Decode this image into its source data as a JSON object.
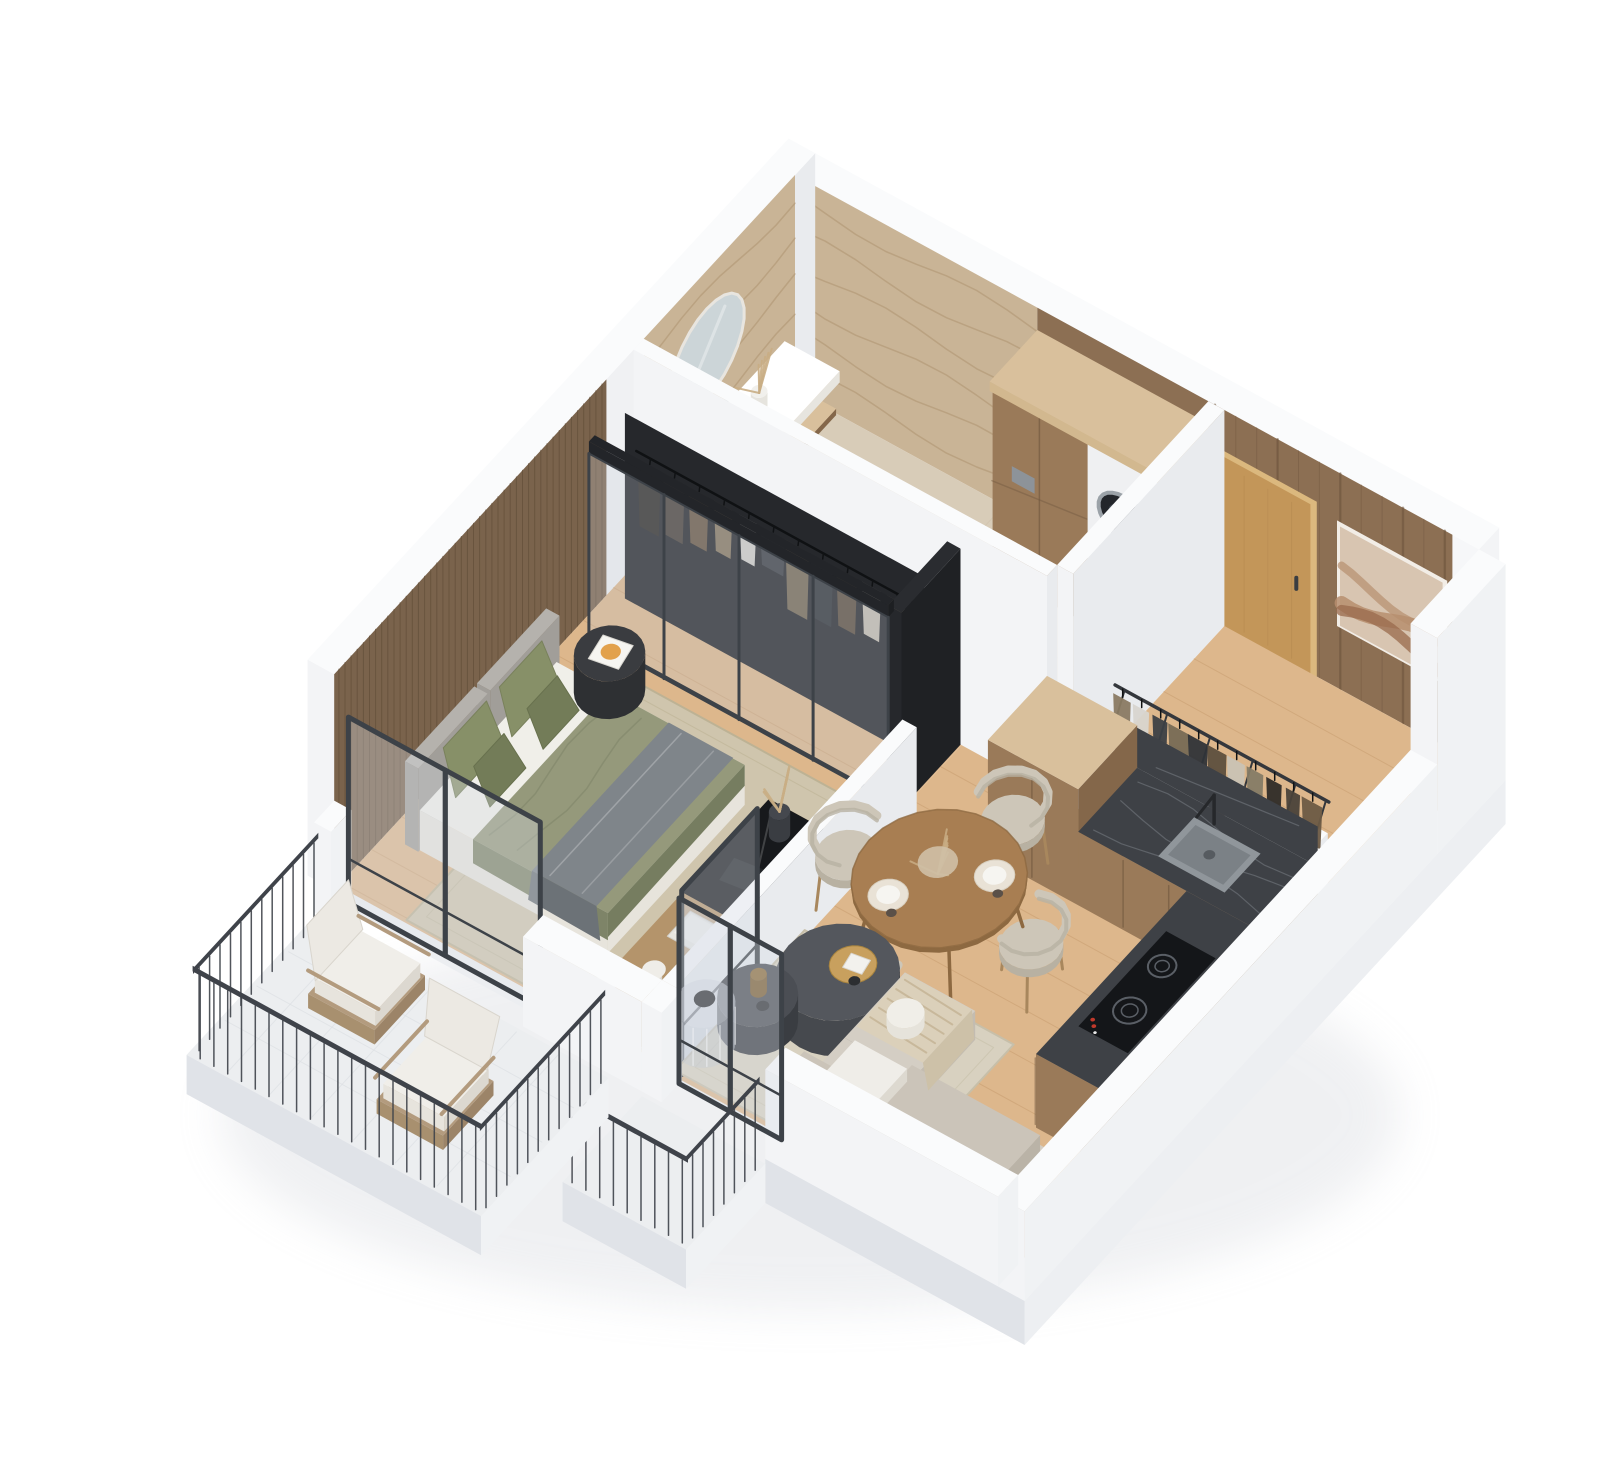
{
  "scene": {
    "title": "3D isometric floor plan render of a one-bedroom apartment with balcony",
    "type": "architectural-isometric-render",
    "rooms": [
      {
        "name": "bathroom",
        "items": [
          "travertine-walls",
          "oval-mirror",
          "vanity-counter",
          "integrated-sink",
          "chrome-faucet",
          "dried-plant",
          "wall-hung-toilet",
          "flush-plate"
        ]
      },
      {
        "name": "utility-column",
        "items": [
          "tall-wood-cabinet",
          "washing-machine-column"
        ]
      },
      {
        "name": "entry-hall",
        "items": [
          "oak-entry-door",
          "wood-panel-wall",
          "abstract-wall-art",
          "open-coat-rack",
          "hanging-clothes"
        ]
      },
      {
        "name": "kitchen",
        "items": [
          "wood-cabinets",
          "dark-marble-counter",
          "dark-marble-backsplash",
          "undermount-sink",
          "black-faucet",
          "induction-cooktop"
        ]
      },
      {
        "name": "dining-area",
        "items": [
          "round-wood-table",
          "curved-dining-chair",
          "curved-dining-chair",
          "curved-dining-chair",
          "curved-dining-chair",
          "dried-flower-centerpiece",
          "place-settings"
        ]
      },
      {
        "name": "living-room",
        "items": [
          "corner-sofa",
          "striped-throw-blanket",
          "ball-pillow",
          "dark-round-coffee-table",
          "small-round-coffee-table",
          "gold-tray",
          "ribbed-glass-side-table",
          "woven-area-rug",
          "glass-partition-panel"
        ]
      },
      {
        "name": "bedroom",
        "items": [
          "wood-slat-wall",
          "double-bed",
          "green-bedding",
          "green-pillows",
          "grey-throw",
          "upholstered-headboard",
          "black-round-side-table",
          "book-with-sun-cover",
          "glass-front-wardrobe",
          "hanging-clothes",
          "tv-console",
          "pampas-vase",
          "laptop",
          "books",
          "table-lamp",
          "beige-area-rug"
        ]
      },
      {
        "name": "balcony",
        "items": [
          "white-tile-floor",
          "black-metal-railing",
          "wood-lounge-chair",
          "wood-lounge-chair"
        ]
      },
      {
        "name": "loggia",
        "items": [
          "glazed-door-panels",
          "black-metal-railing"
        ]
      }
    ]
  },
  "palette": {
    "background": "#ffffff",
    "wallTop": "#fafbfc",
    "wallWhiteA": "#e9ebee",
    "wallWhiteB": "#f3f4f6",
    "wallOuter": "#f0f2f4",
    "wallOuterShade": "#e0e3e8",
    "plinth": "#edeff2",
    "floorWood": "#ddb78c",
    "floorWoodLine": "#c69b6d",
    "floorStone": "#d8ccb8",
    "floorStoneLine": "#c6b79e",
    "balconyFloor": "#eceef0",
    "balconyLine": "#dde0e4",
    "travertine": "#c9b496",
    "travertineStreak": "#ab906c",
    "woodPanel": "#8c6f53",
    "woodPanelLine": "#6f563e",
    "slatWood": "#7a634c",
    "slatLine": "#64503a",
    "oakDoor": "#c39659",
    "oakDoorEdge": "#dbb87e",
    "handle": "#3a3d41",
    "artBg": "#d8c5b1",
    "artMid": "#b78e6e",
    "artDark": "#996a4c",
    "artFrame": "#f2ede6",
    "rackRail": "#34373c",
    "counterDark": "#3e4146",
    "counterVein": "#7e838a",
    "kitchenWood": "#9a7a59",
    "kitchenWoodDark": "#84674a",
    "lightWoodTop": "#d9c09c",
    "sinkGray": "#90969b",
    "sinkInner": "#7b8186",
    "cooktop": "#141619",
    "burnerRing": "#5a5f66",
    "redDot": "#c0392b",
    "tableWood": "#a87e52",
    "tableWoodDark": "#8d6941",
    "chairSeat": "#cdc6b8",
    "chairSeatShade": "#b8b1a2",
    "chairWood": "#a8875d",
    "sofa": "#d4cec4",
    "sofaShade": "#c3bcb1",
    "sofaBack": "#cbc4b9",
    "pouf": "#efede8",
    "blanket": "#dbd0ba",
    "blanketLine": "#c4b394",
    "coffeeDark": "#46494e",
    "coffeeDarkTop": "#54575d",
    "coffeeDark2": "#3a3d42",
    "gold": "#c8a05e",
    "glass": "rgba(196,206,216,0.28)",
    "glassLight": "rgba(215,222,230,0.35)",
    "frameDark": "#3d4248",
    "bedGreen": "#95997b",
    "bedGreenDark": "#7e8468",
    "pillowGreen": "#879068",
    "pillowGreenDark": "#737c58",
    "sheetWhite": "#f0efe9",
    "mattressSide": "#e7e4dc",
    "throwGray": "#7f858a",
    "throwGrayDark": "#6c7277",
    "headboard": "#a19e99",
    "headboardTop": "#b5b2ad",
    "rugLiving": "#d8d1c0",
    "rugLivingEdge": "#c7bfa9",
    "rugBedroom": "#cfc5ad",
    "rugBedroomEdge": "#bdb294",
    "sideTableBlack": "#2e3033",
    "sideTableTop": "#3a3c40",
    "consoleWood": "#b4946b",
    "consoleBlack": "#17191c",
    "white": "#ffffff",
    "offWhite": "#f4f3ef",
    "chrome": "#9aa2a8",
    "washerDark": "#23262b",
    "washerRing": "#9ba2a8",
    "plant": "#c9ae85",
    "mirror": "#ccd5d8",
    "mirrorFrame": "#e8e5df",
    "railDark": "#3f434a",
    "shadow": "#b9bec7",
    "clothes": [
      "#2e2b28",
      "#4a423a",
      "#6b5a44",
      "#8a7a62",
      "#d8d5cf",
      "#3c3f45",
      "#776a55",
      "#2f3338",
      "#5d4f3e",
      "#c9c2b4",
      "#857b66"
    ]
  }
}
